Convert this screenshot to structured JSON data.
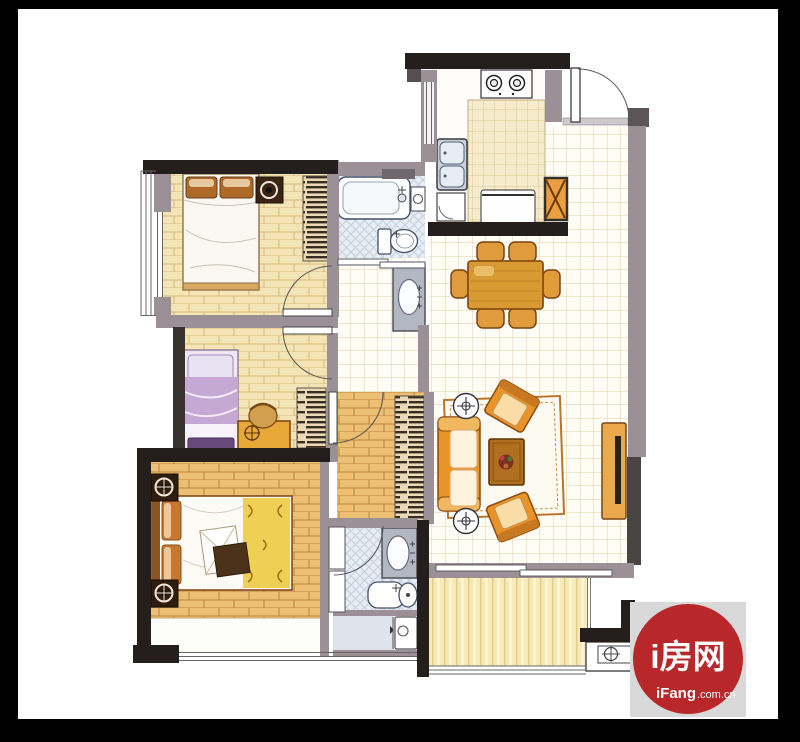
{
  "watermark": {
    "title": "i房网",
    "brand": "iFang",
    "suffix": ".com.cn",
    "circle_color": "#b8272a",
    "square_color": "#d9d9d9"
  },
  "colors": {
    "frame_black": "#000000",
    "wall_black": "#241f1c",
    "wall_gray": "#9a9096",
    "wall_dark_gray": "#4a4542",
    "wood_light": "#f3e5b5",
    "wood_orange": "#ecbf72",
    "tile_line": "#e7cba2",
    "bathroom_blue": "#e7edf3",
    "balcony_yellow": "#f7eab6",
    "furniture_orange": "#e89428",
    "table_wood": "#d89a33",
    "flue_orange": "#eb9f40",
    "bed2_lavender": "#c5a8d4"
  },
  "icons": {
    "lamp_symbol": "target-circle",
    "table_symbol": "crosshair-circle",
    "ac_platform_symbol": "crosshair-circle"
  }
}
